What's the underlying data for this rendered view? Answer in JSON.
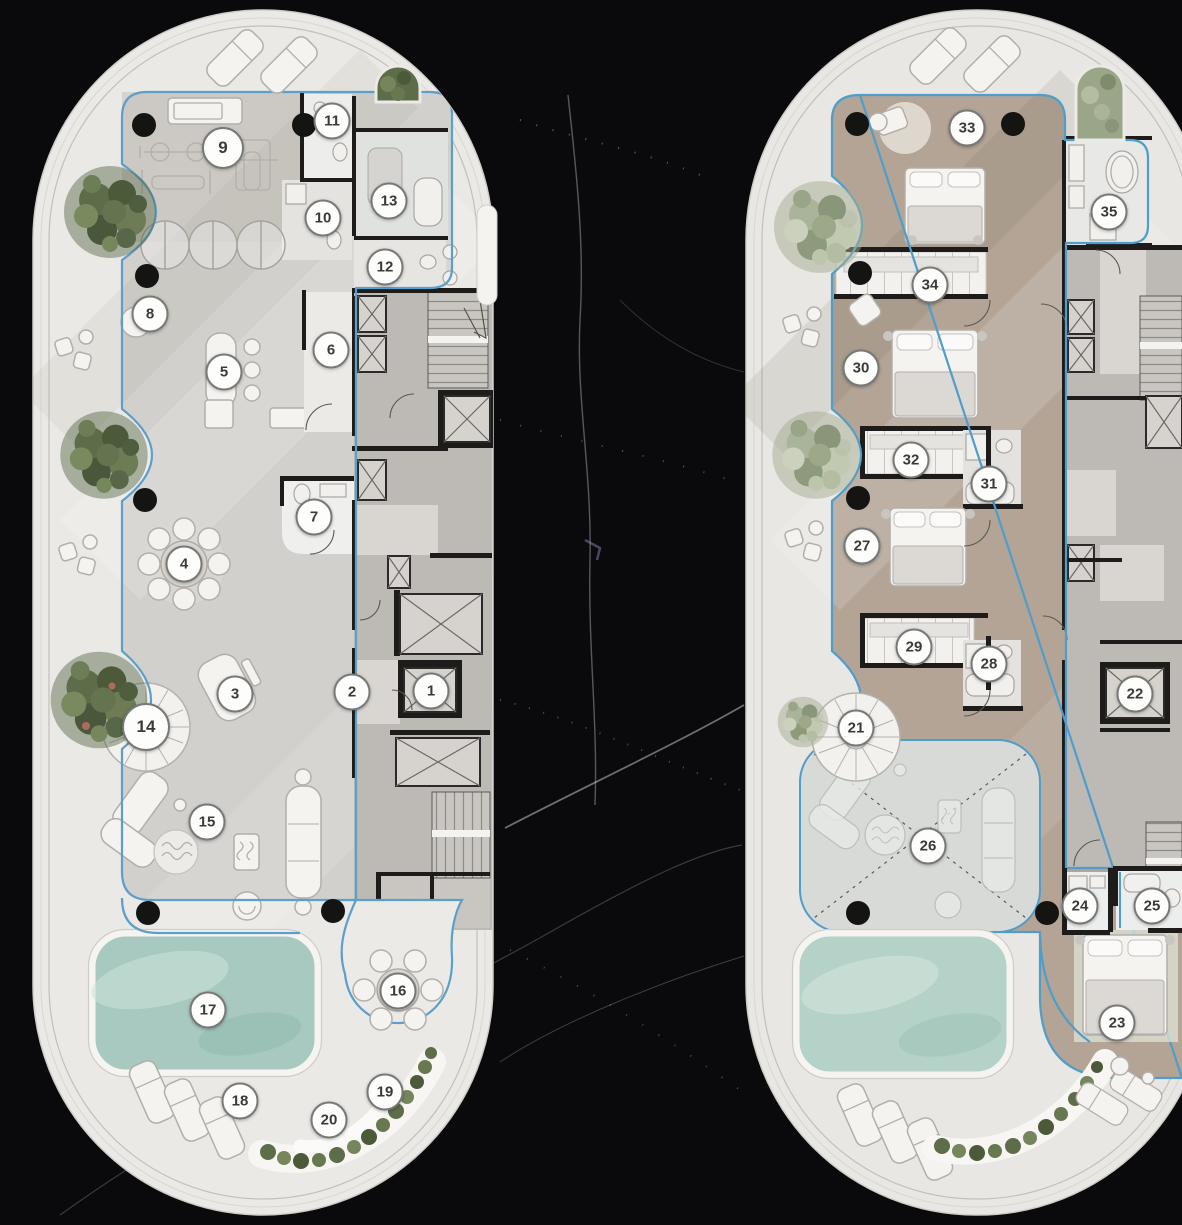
{
  "figure": {
    "kind": "architectural-floor-plans",
    "plans": [
      "left-tower-plate",
      "right-tower-plate"
    ],
    "background": "black-marble"
  },
  "palette": {
    "background": "#0a0a0c",
    "marble_vein": "#c9cbd2",
    "plate_white": "#ebe9e5",
    "left_floor_gray": "#d2d0cc",
    "right_floor_tan": "#b3a495",
    "double_height_gray": "#d8dad8",
    "pool_teal": "#a7c9bf",
    "outline_blue": "#5b9fca",
    "wall_black": "#1d1c1a",
    "core_gray": "#bdb9b5",
    "plant_dark": "#5e6d49",
    "plant_sage": "#9aa687",
    "marker_fill": "#fdfdfc",
    "marker_border": "#787876",
    "marker_text": "#3a3a38"
  },
  "marker_style": {
    "size": 37
  },
  "left_plan": {
    "markers": [
      {
        "label": "1",
        "x": 431,
        "y": 691
      },
      {
        "label": "2",
        "x": 352,
        "y": 692
      },
      {
        "label": "3",
        "x": 235,
        "y": 694
      },
      {
        "label": "4",
        "x": 184,
        "y": 564
      },
      {
        "label": "5",
        "x": 224,
        "y": 372
      },
      {
        "label": "6",
        "x": 331,
        "y": 350
      },
      {
        "label": "7",
        "x": 314,
        "y": 517
      },
      {
        "label": "8",
        "x": 150,
        "y": 314
      },
      {
        "label": "9",
        "x": 223,
        "y": 148,
        "size": 42
      },
      {
        "label": "10",
        "x": 323,
        "y": 218
      },
      {
        "label": "11",
        "x": 332,
        "y": 121
      },
      {
        "label": "12",
        "x": 385,
        "y": 267
      },
      {
        "label": "13",
        "x": 389,
        "y": 201
      },
      {
        "label": "14",
        "x": 146,
        "y": 727,
        "size": 48
      },
      {
        "label": "15",
        "x": 207,
        "y": 822
      },
      {
        "label": "16",
        "x": 398,
        "y": 991
      },
      {
        "label": "17",
        "x": 208,
        "y": 1010
      },
      {
        "label": "18",
        "x": 240,
        "y": 1101
      },
      {
        "label": "19",
        "x": 385,
        "y": 1092
      },
      {
        "label": "20",
        "x": 329,
        "y": 1120
      }
    ]
  },
  "right_plan": {
    "markers": [
      {
        "label": "21",
        "x": 856,
        "y": 728
      },
      {
        "label": "22",
        "x": 1135,
        "y": 694
      },
      {
        "label": "23",
        "x": 1117,
        "y": 1023
      },
      {
        "label": "24",
        "x": 1080,
        "y": 906
      },
      {
        "label": "25",
        "x": 1152,
        "y": 906
      },
      {
        "label": "26",
        "x": 928,
        "y": 846
      },
      {
        "label": "27",
        "x": 862,
        "y": 546
      },
      {
        "label": "28",
        "x": 989,
        "y": 664
      },
      {
        "label": "29",
        "x": 914,
        "y": 647
      },
      {
        "label": "30",
        "x": 861,
        "y": 368
      },
      {
        "label": "31",
        "x": 989,
        "y": 484
      },
      {
        "label": "32",
        "x": 911,
        "y": 460
      },
      {
        "label": "33",
        "x": 967,
        "y": 128
      },
      {
        "label": "34",
        "x": 930,
        "y": 285
      },
      {
        "label": "35",
        "x": 1109,
        "y": 212
      }
    ]
  }
}
